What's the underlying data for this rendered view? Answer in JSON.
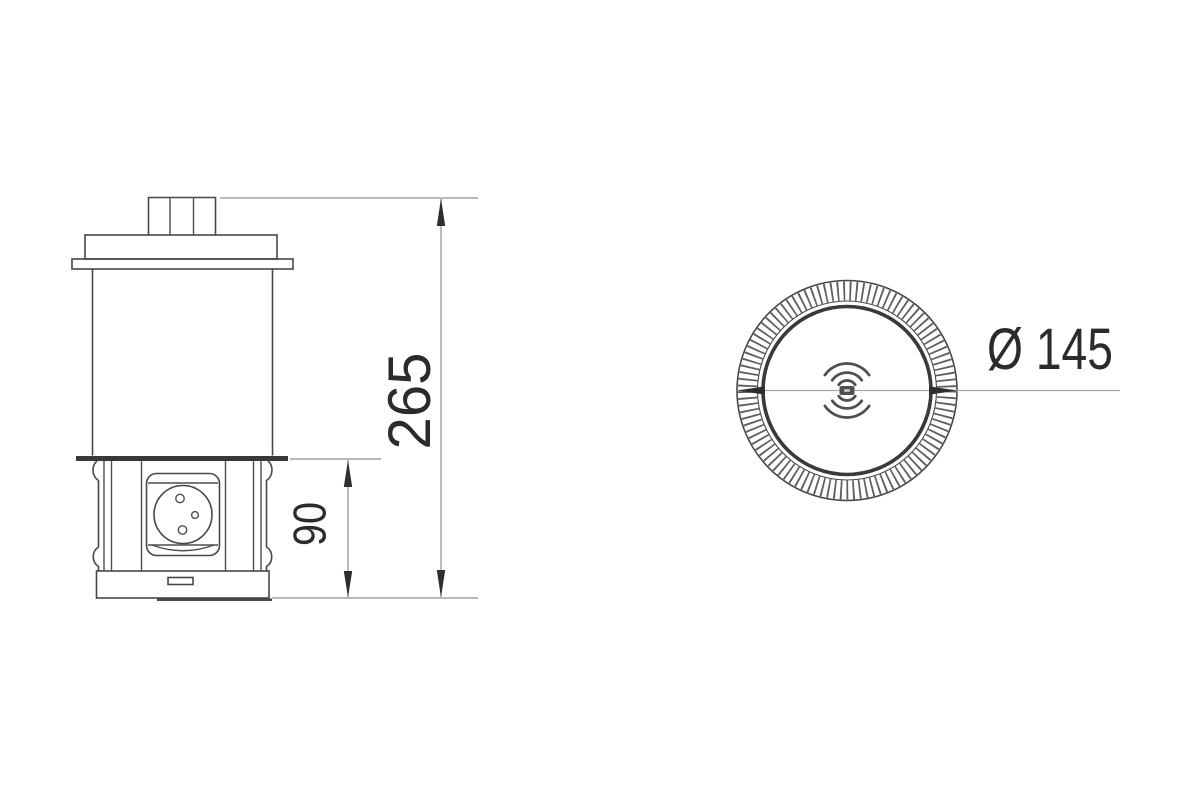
{
  "drawing": {
    "title": "Pop-up countertop socket technical drawing",
    "colors": {
      "background": "#ffffff",
      "object_line": "#474747",
      "dimension_line": "#8f8f8f",
      "text": "#2b2b2b"
    },
    "views": {
      "side_view": {
        "label": "side elevation"
      },
      "top_view": {
        "label": "top view"
      }
    },
    "dimensions": {
      "overall_height": "265",
      "raised_height": "90",
      "diameter": "Ø 145"
    },
    "icons": {
      "wireless_charging": "concentric-arcs",
      "power_socket": "circle-with-pin-holes"
    }
  }
}
